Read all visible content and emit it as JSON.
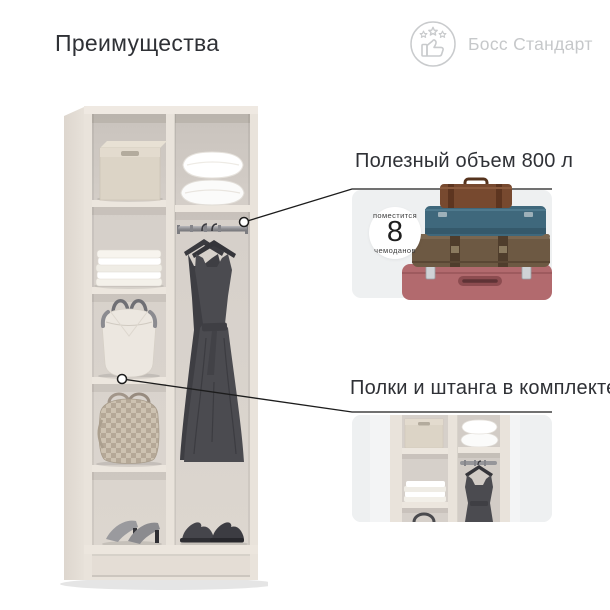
{
  "header": {
    "title": "Преимущества",
    "brand": {
      "label": "Босс Стандарт",
      "icon": "thumbs-up-stars-icon"
    }
  },
  "wardrobe": {
    "description": "open-two-column-wardrobe-render",
    "items": [
      "storage-box",
      "folded-linens",
      "white-handbag",
      "checkered-handbag",
      "women-heels",
      "pillows",
      "hanging-rod",
      "dress-on-hangers",
      "men-shoes"
    ]
  },
  "callouts": [
    {
      "title": "Полезный объем 800 л",
      "badge": {
        "top": "поместится",
        "number": "8",
        "bottom": "чемоданов"
      },
      "image": "suitcase-stack"
    },
    {
      "title": "Полки и штанга в комплекте",
      "image": "wardrobe-interior-closeup"
    }
  ],
  "colors": {
    "background": "#ffffff",
    "text": "#2f3136",
    "muted": "#c6c8ca",
    "card": "#eef0f1",
    "callout_line": "#1c1c1c",
    "wood": "#e9e3db",
    "interior": "#d4cec8",
    "dress": "#4b4b50",
    "suitcase_teal": "#3f687c",
    "suitcase_brown": "#77492f",
    "suitcase_khaki": "#6d5943",
    "suitcase_pink": "#b26a6e"
  }
}
